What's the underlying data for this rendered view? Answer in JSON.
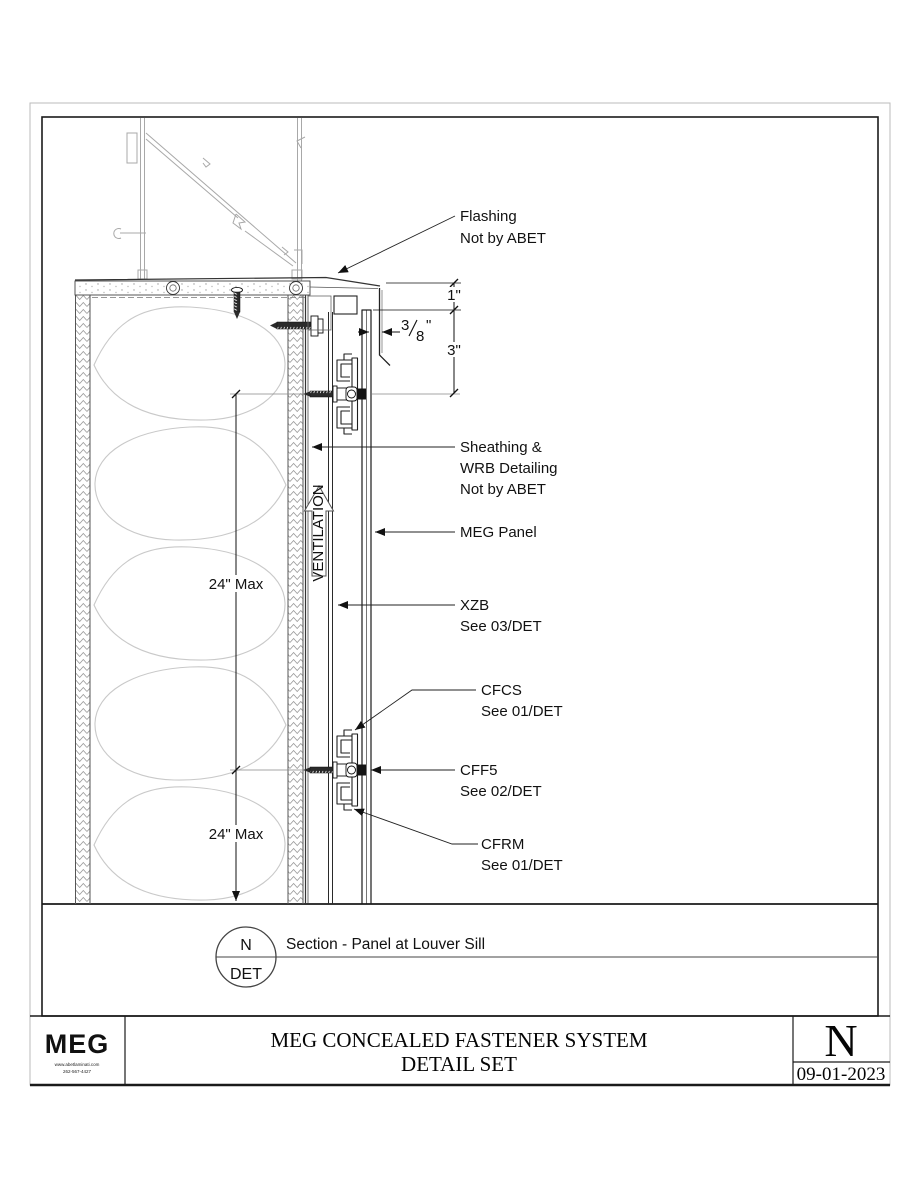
{
  "labels": {
    "flashing": [
      "Flashing",
      "Not by ABET"
    ],
    "sheathing": [
      "Sheathing &",
      "WRB Detailing",
      "Not by ABET"
    ],
    "meg_panel": "MEG Panel",
    "xzb": [
      "XZB",
      "See 03/DET"
    ],
    "cfcs": [
      "CFCS",
      "See 01/DET"
    ],
    "cff5": [
      "CFF5",
      "See 02/DET"
    ],
    "cfrm": [
      "CFRM",
      "See 01/DET"
    ],
    "ventilation": "VENTILATION"
  },
  "dims": {
    "one": "1\"",
    "three": "3\"",
    "frac_num": "3",
    "frac_den": "8",
    "frac_unit": "\"",
    "max_upper": "24\" Max",
    "max_lower": "24\" Max"
  },
  "callout": {
    "top": "N",
    "bottom": "DET",
    "title": "Section - Panel at Louver Sill"
  },
  "titleblock": {
    "logo_text": "MEG",
    "logo_sub1": "www.abetlaminati.com",
    "logo_sub2": "262-567-4427",
    "title_line1": "MEG CONCEALED FASTENER SYSTEM",
    "title_line2": "DETAIL SET",
    "sheet": "N",
    "date": "09-01-2023"
  },
  "colors": {
    "line_dark": "#1a1a1a",
    "line_mid": "#555555",
    "line_light": "#aaaaaa",
    "insulation": "#c9c9c9"
  }
}
